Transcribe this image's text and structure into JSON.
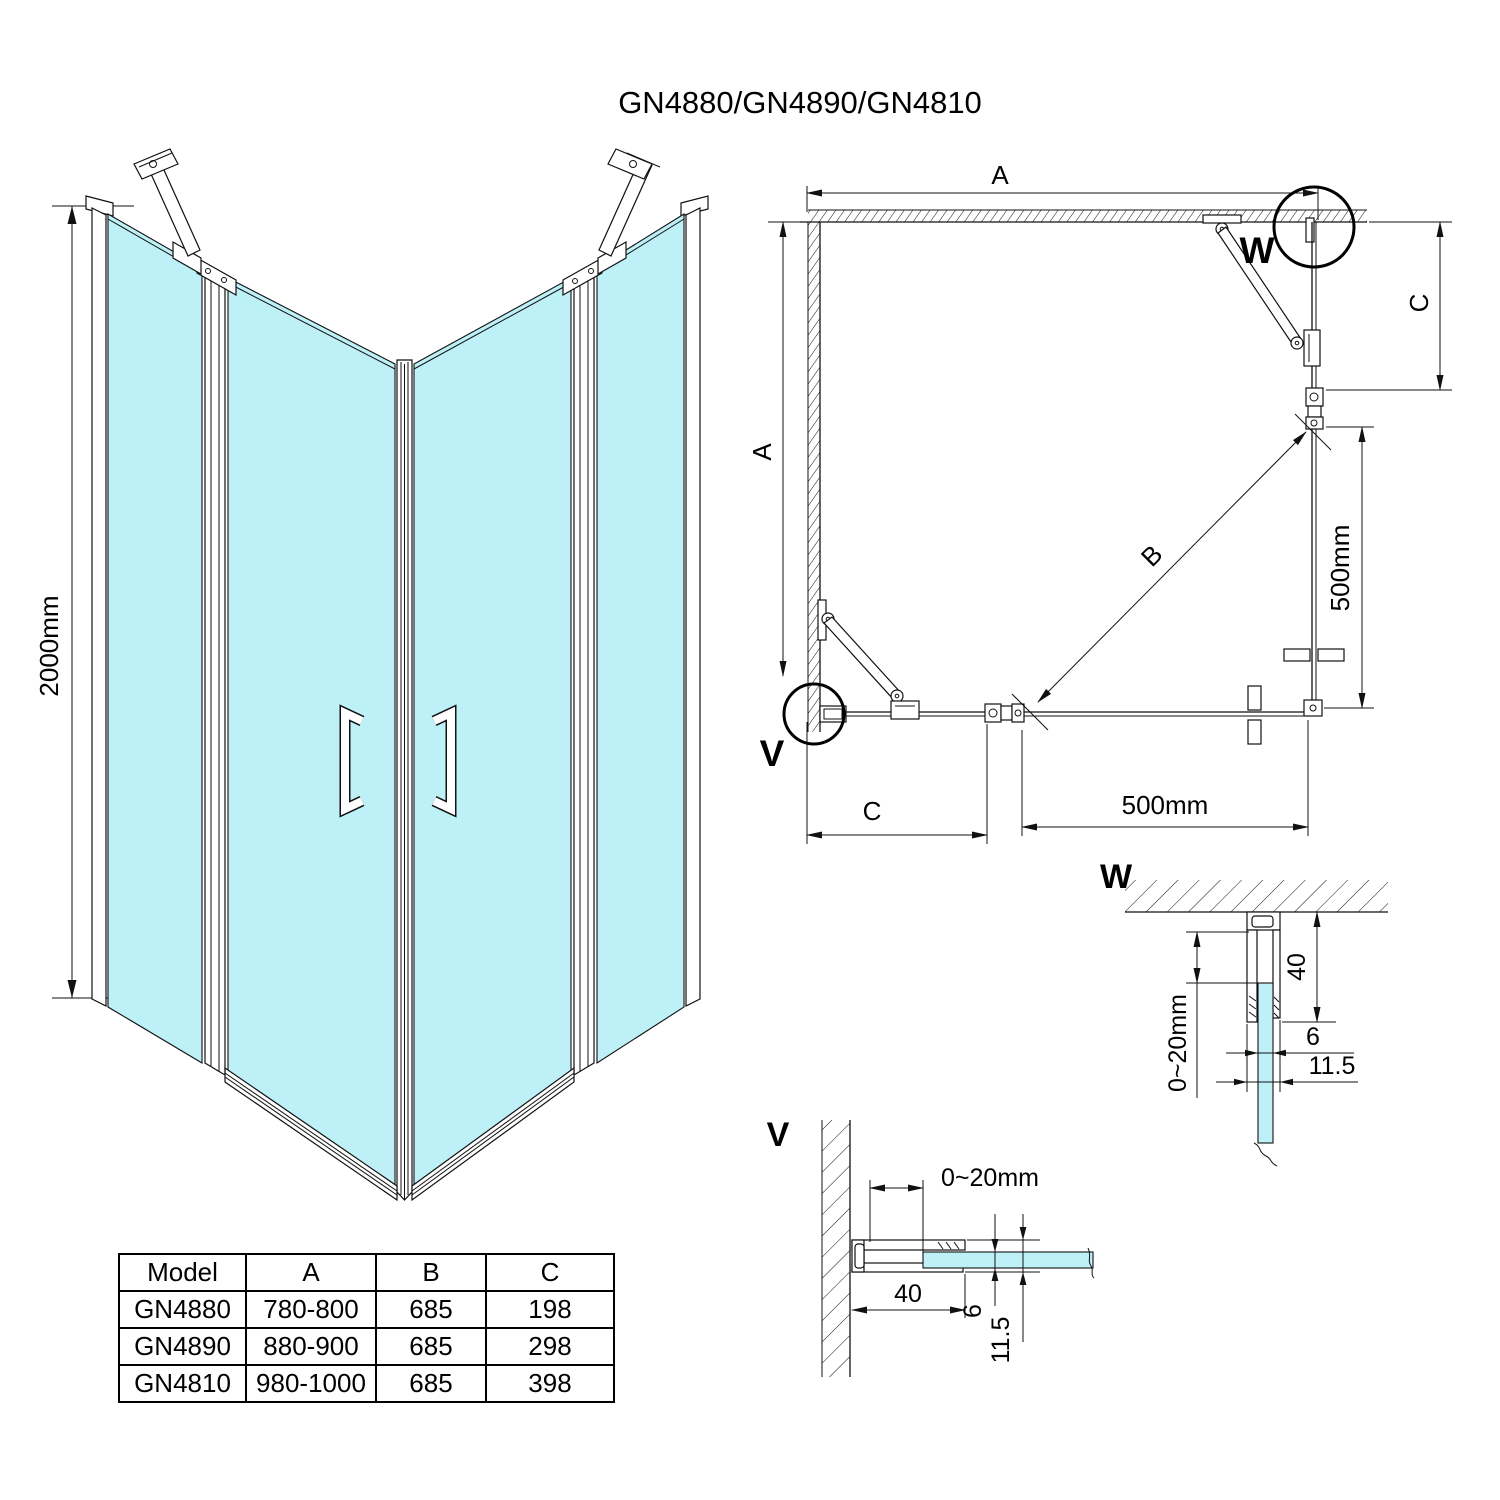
{
  "title": "GN4880/GN4890/GN4810",
  "colors": {
    "glass": "#BEF1F7",
    "line": "#111111",
    "background": "#ffffff"
  },
  "iso": {
    "height_dim": "2000mm"
  },
  "plan": {
    "dim_a_top": "A",
    "dim_a_left": "A",
    "dim_c_right": "C",
    "dim_c_bottom": "C",
    "dim_b": "B",
    "dim_500_right": "500mm",
    "dim_500_bottom": "500mm",
    "callout_w": "W",
    "callout_v": "V"
  },
  "detail_w": {
    "label": "W",
    "dim_depth": "40",
    "dim_adjust": "0~20mm",
    "dim_glass": "6",
    "dim_profile": "11.5"
  },
  "detail_v": {
    "label": "V",
    "dim_adjust": "0~20mm",
    "dim_depth": "40",
    "dim_glass": "6",
    "dim_profile": "11.5"
  },
  "table": {
    "headers": [
      "Model",
      "A",
      "B",
      "C"
    ],
    "rows": [
      [
        "GN4880",
        "780-800",
        "685",
        "198"
      ],
      [
        "GN4890",
        "880-900",
        "685",
        "298"
      ],
      [
        "GN4810",
        "980-1000",
        "685",
        "398"
      ]
    ]
  }
}
